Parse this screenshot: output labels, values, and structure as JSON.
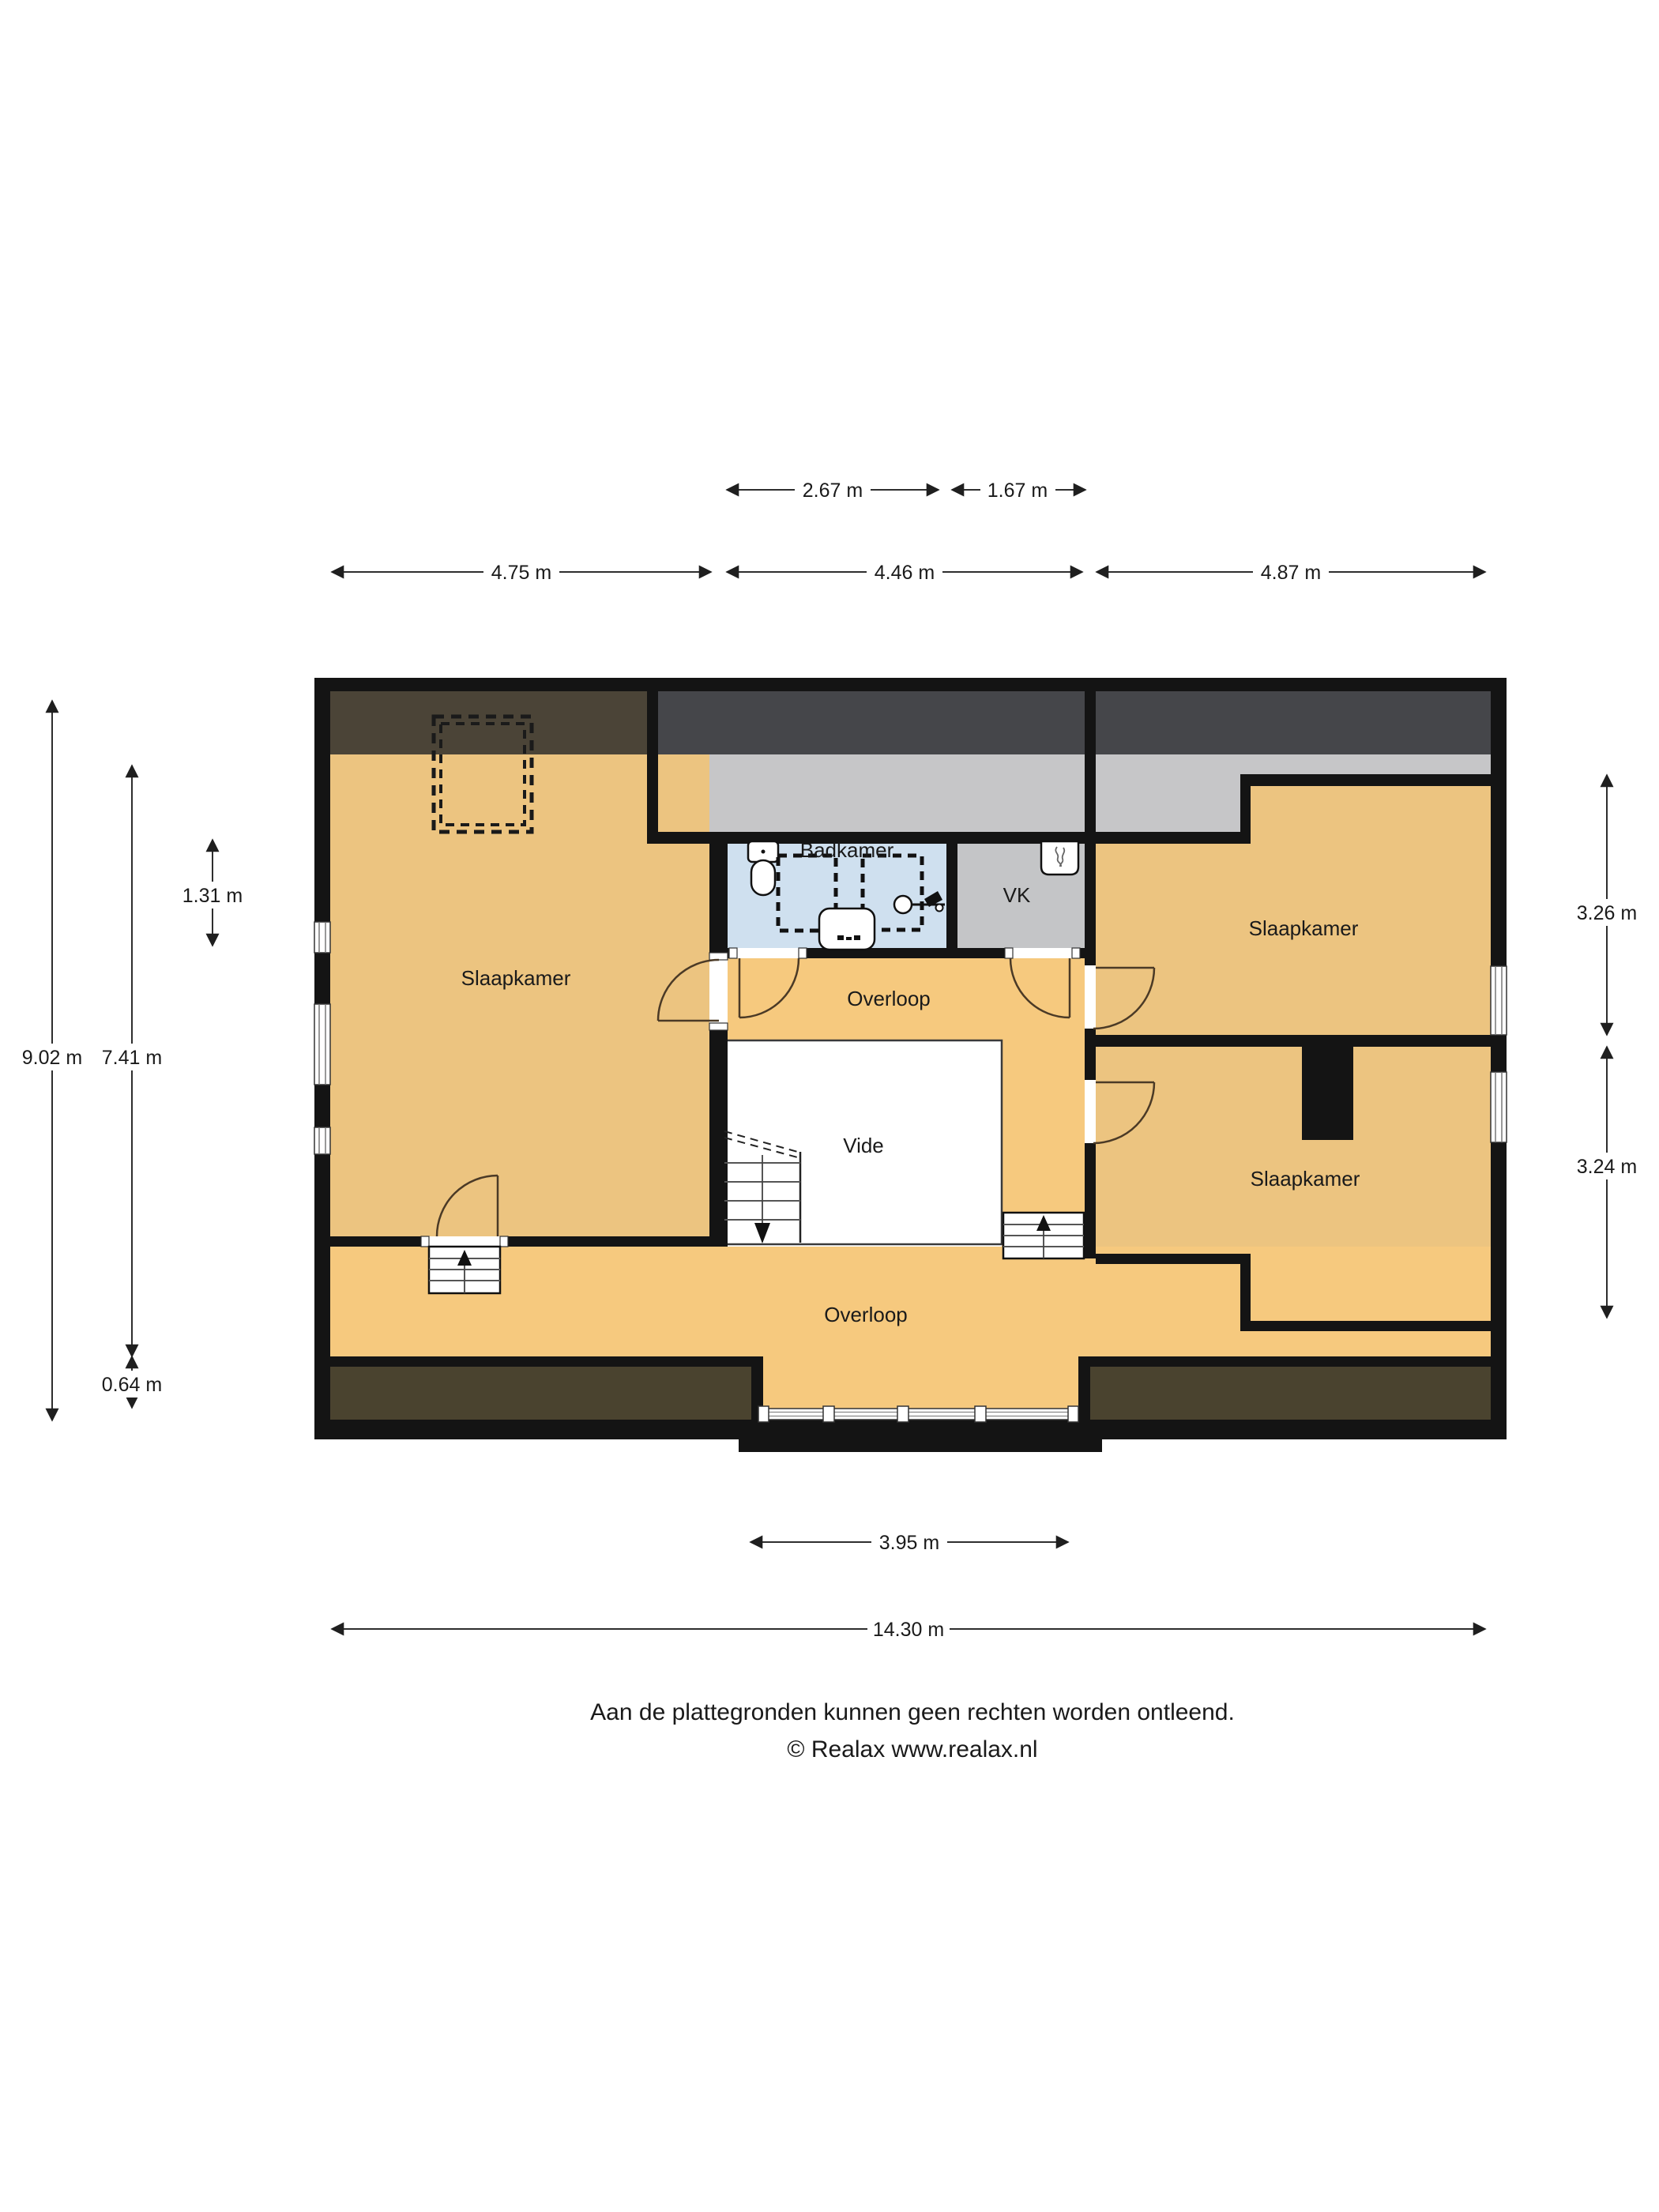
{
  "floor_plan": {
    "rooms": [
      {
        "id": "slaapkamer-left",
        "label": "Slaapkamer"
      },
      {
        "id": "badkamer",
        "label": "Badkamer"
      },
      {
        "id": "vk",
        "label": "VK"
      },
      {
        "id": "slaapkamer-top-right",
        "label": "Slaapkamer"
      },
      {
        "id": "overloop-top",
        "label": "Overloop"
      },
      {
        "id": "vide",
        "label": "Vide"
      },
      {
        "id": "slaapkamer-bottom-right",
        "label": "Slaapkamer"
      },
      {
        "id": "overloop-bottom",
        "label": "Overloop"
      }
    ],
    "icons": [
      "toilet-icon",
      "shower-area-dashed",
      "washbasin-icon",
      "round-sink-icon",
      "wall-faucet-icon",
      "ventilation-unit-icon",
      "stairs-up-icon",
      "stairs-down-icon",
      "door-swing-icon",
      "window-icon",
      "chimney-block",
      "roof-window-dashed"
    ],
    "colors": {
      "wall": "#141414",
      "room_tan": "#ecc480",
      "hall_tan": "#f6c97e",
      "bathroom_blue": "#cfe0ef",
      "vk_gray": "#c4c5c7",
      "attic_dark_left": "#4b4437",
      "attic_dark_mid": "#45464a",
      "attic_light_gray": "#c6c6c8",
      "knee_wall_brown": "#4a432f",
      "vide_white": "#ffffff"
    }
  },
  "dimensions": {
    "top_inner": {
      "badkamer_width": "2.67 m",
      "vk_width": "1.67 m"
    },
    "top": {
      "left": "4.75 m",
      "middle": "4.46 m",
      "right": "4.87 m"
    },
    "left": {
      "total_height": "9.02 m",
      "interior_height": "7.41 m",
      "badkamer_height": "1.31 m",
      "knee_wall": "0.64 m"
    },
    "right": {
      "top_bedroom": "3.26 m",
      "bottom_bedroom": "3.24 m"
    },
    "bottom": {
      "bay": "3.95 m",
      "total_width": "14.30 m"
    }
  },
  "footer": {
    "line1": "Aan de plattegronden kunnen geen rechten worden ontleend.",
    "line2": "© Realax www.realax.nl"
  }
}
